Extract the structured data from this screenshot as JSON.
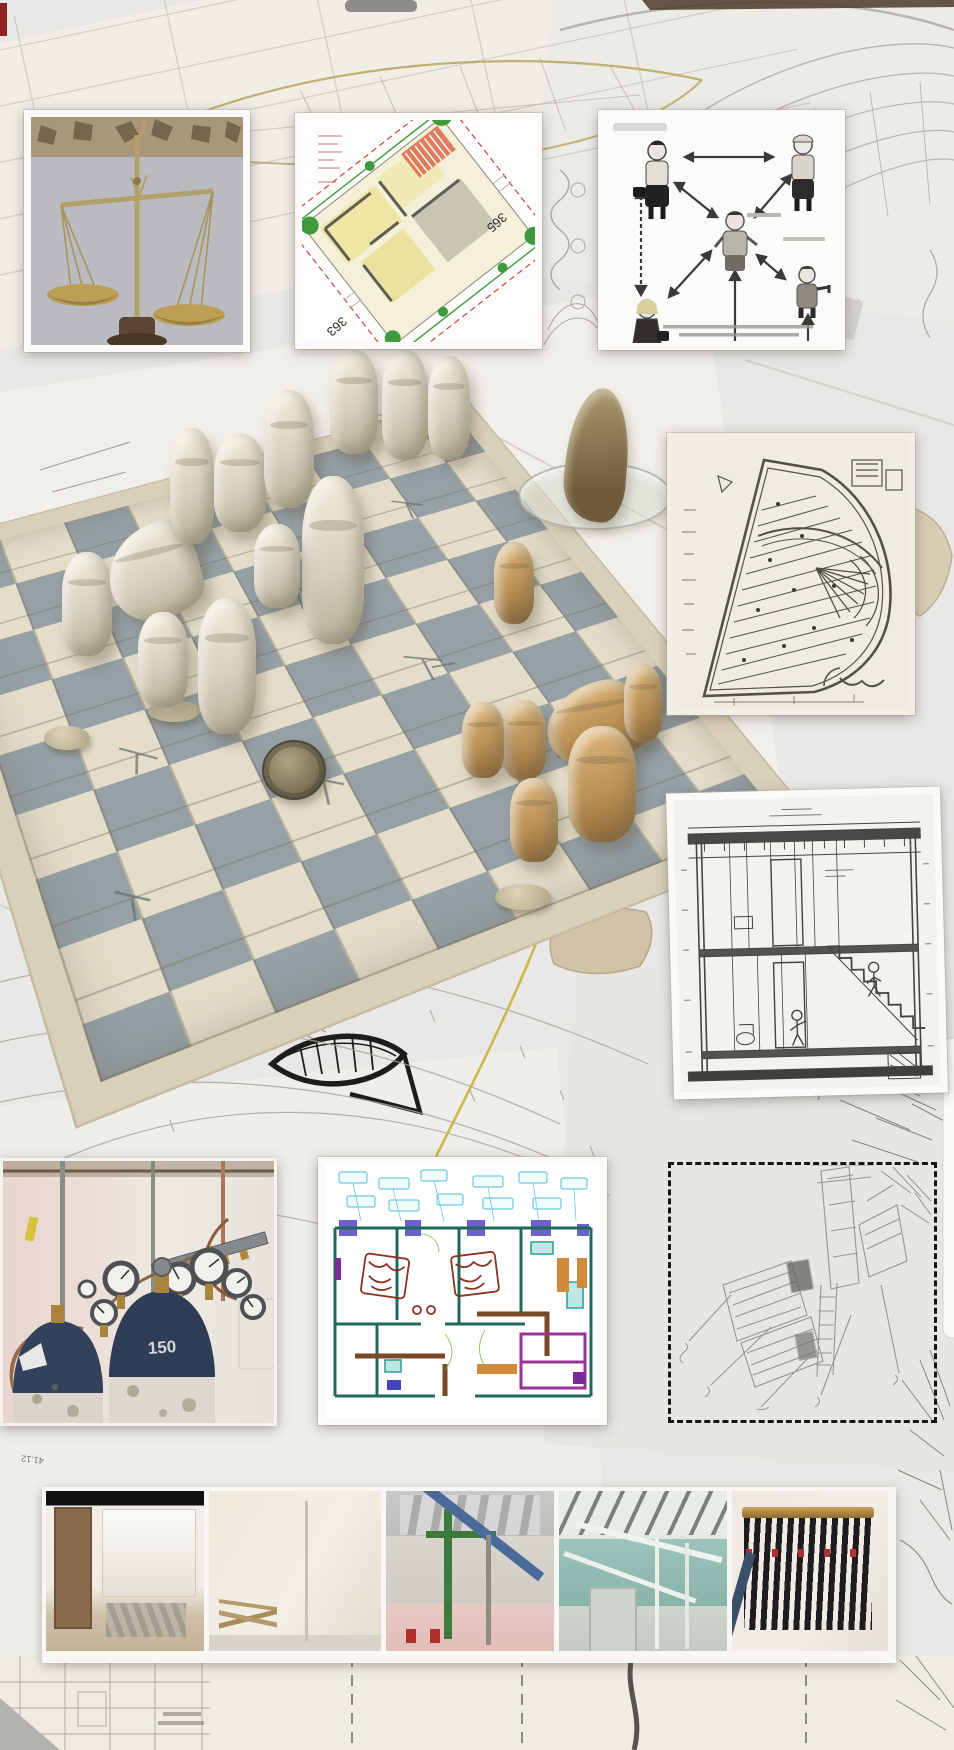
{
  "canvas": {
    "bg_color": "#e9e8e6",
    "width": 954,
    "height": 1750
  },
  "annotations": {
    "circled_number": "110",
    "elevation_number": "41.12"
  },
  "site_plan_tile": {
    "plot_number_right": "365",
    "plot_number_left": "363",
    "colors": {
      "room_yellow": "#efe6a6",
      "tree_green": "#3f9a3f",
      "roof_red": "#c06a4a",
      "boundary_red": "#cc4444"
    }
  },
  "gas_photo": {
    "cylinder_number": "150",
    "colors": {
      "cylinder_navy": "#2e3d55",
      "brass": "#ab853c",
      "wall_pink": "#e8d6cf"
    }
  },
  "chess_photo": {
    "board_cream": "#e4ddc9",
    "board_gray": "#96a0a5",
    "piece_white": "#d7d0bd",
    "piece_tan": "#bb9257"
  },
  "diagram_tile": {
    "figure_count": 5
  },
  "photo_strip": {
    "photo_count": 5
  },
  "palette": {
    "cad_cyan": "#6fcadf",
    "cad_purple": "#5a50c8",
    "cad_maroon": "#8a3222",
    "dashed_border": "#151515",
    "pencil": "#8f8c84"
  }
}
